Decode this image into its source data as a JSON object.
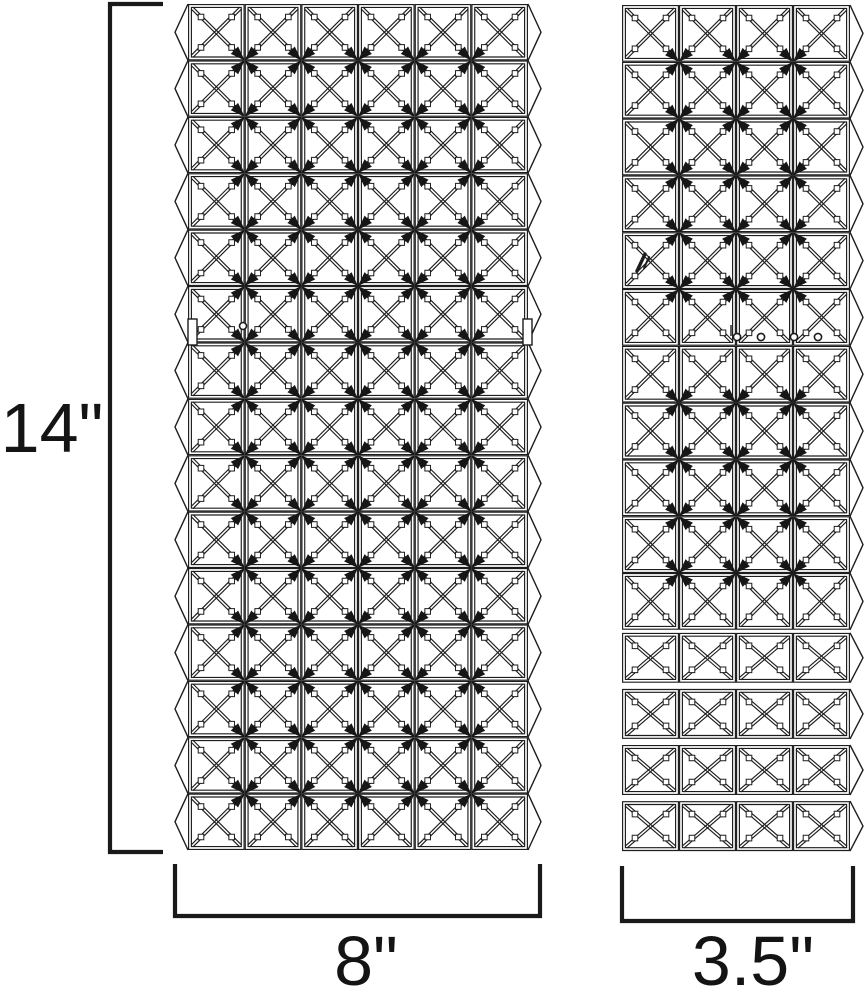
{
  "drawing": {
    "labels": {
      "height": "14\"",
      "front_width": "8\"",
      "side_width": "3.5\""
    },
    "front_panel": {
      "name": "front crystal panel",
      "columns": 6,
      "rows": 15,
      "mounting_tabs": 2,
      "pin_holes": 1
    },
    "side_panel": {
      "name": "side crystal panel",
      "columns": 4,
      "attached_rows": 11,
      "detached_rows": 4,
      "plain_boundary_row": 6,
      "screw_holes": 4
    },
    "colors": {
      "ink": "#1a1a1a",
      "background": "#ffffff"
    }
  }
}
